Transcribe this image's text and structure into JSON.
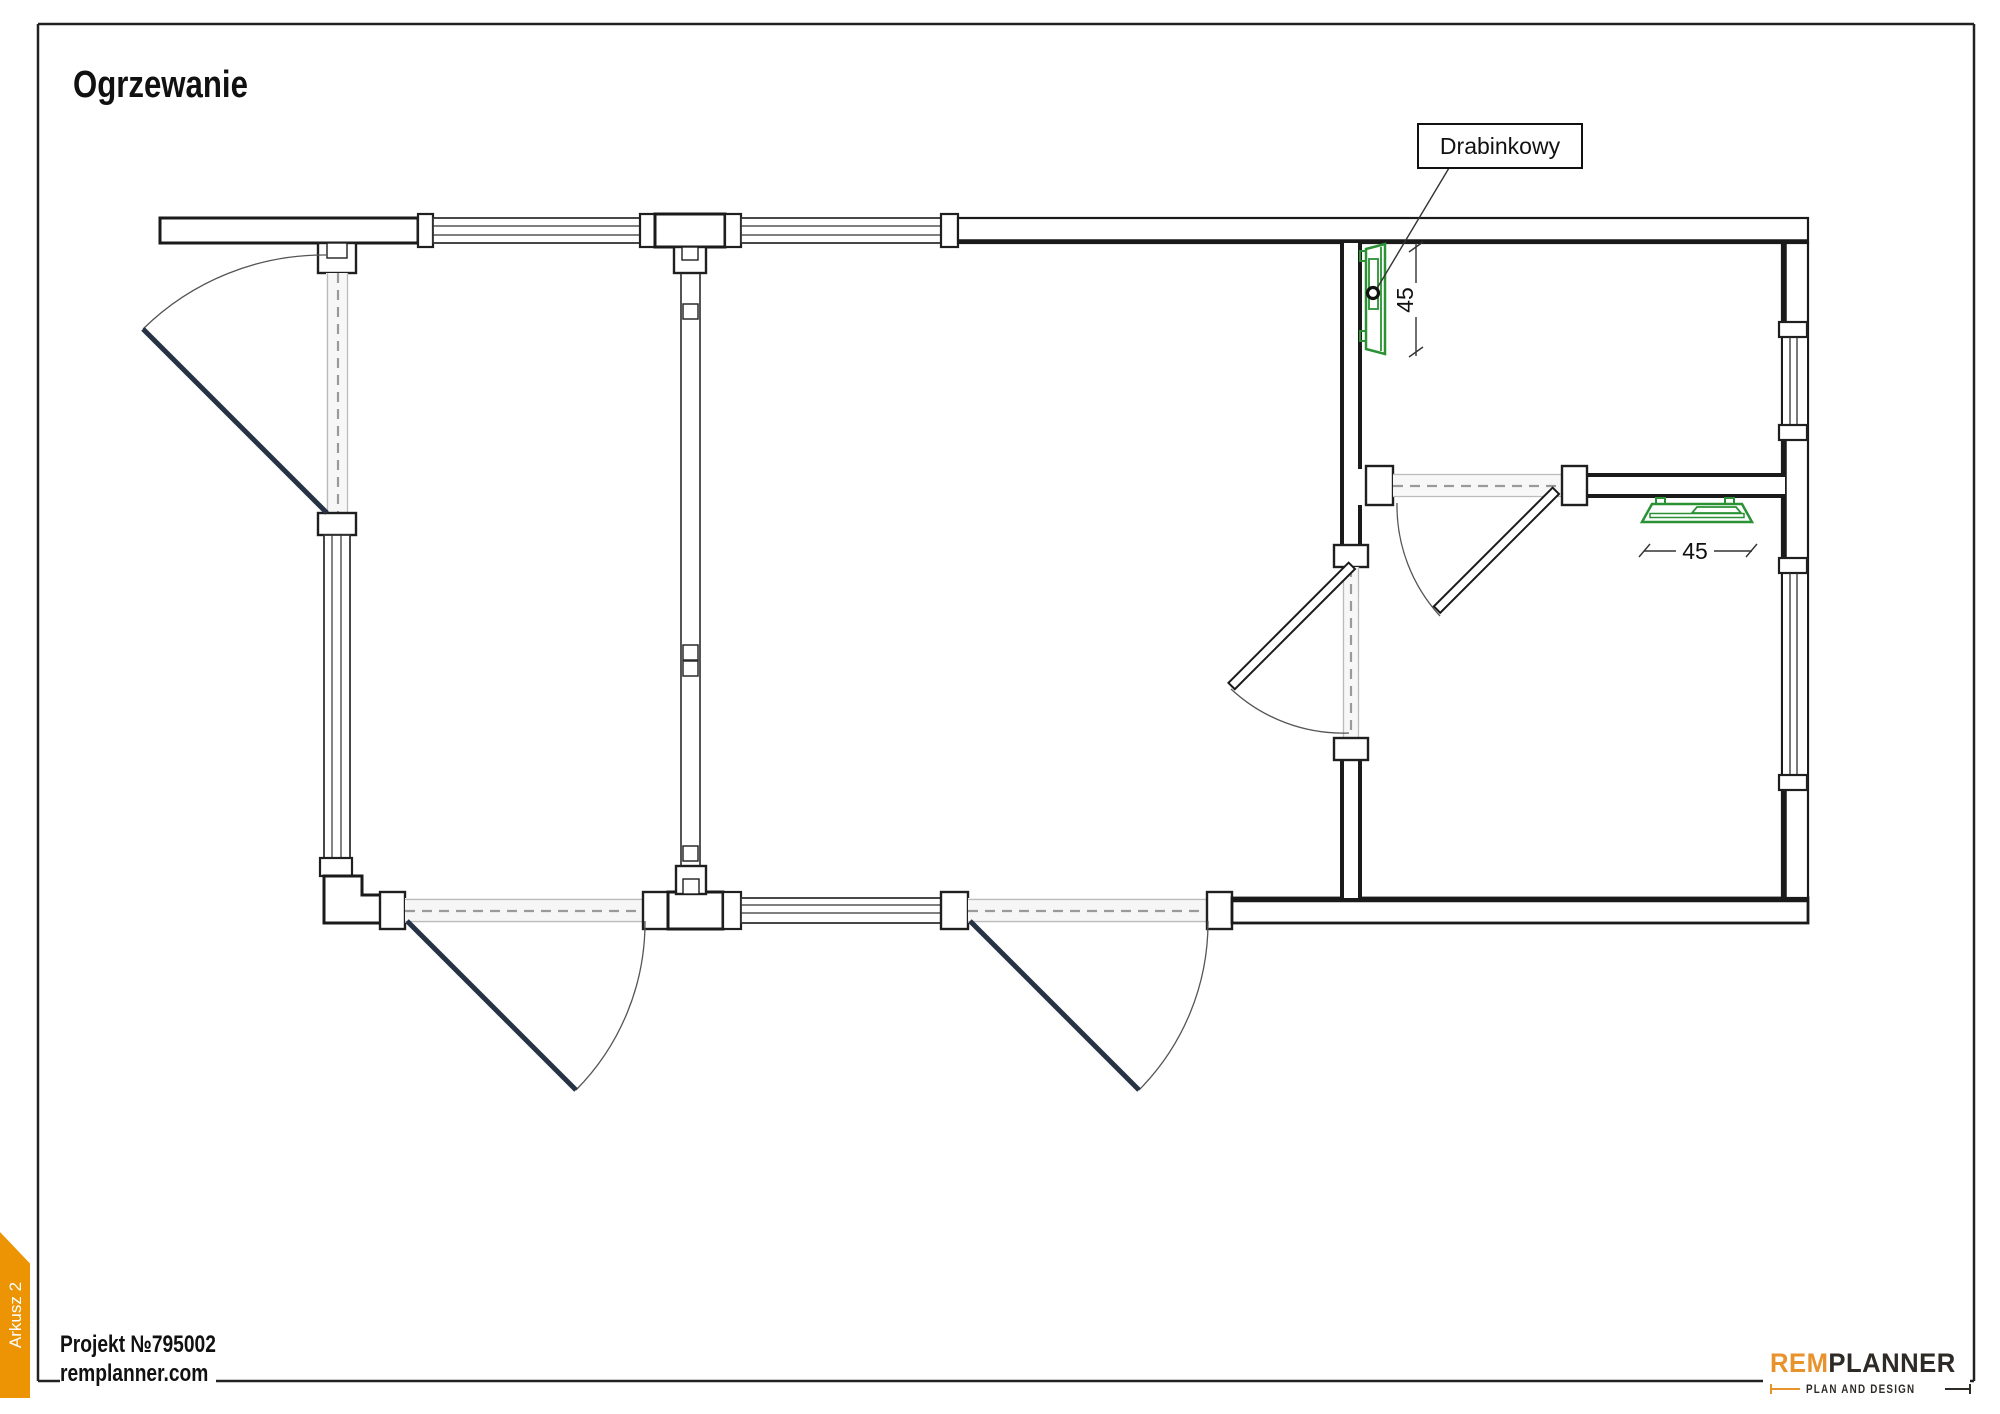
{
  "page": {
    "title": "Ogrzewanie",
    "border_color": "#222222"
  },
  "plan": {
    "annotation_label": "Drabinkowy",
    "dimensions": [
      {
        "value": "45",
        "orientation": "vertical",
        "target": "towel-radiator-top-right-room"
      },
      {
        "value": "45",
        "orientation": "horizontal",
        "target": "towel-radiator-bottom-right-room"
      }
    ],
    "radiators": [
      {
        "type": "drabinkowy-towel-radiator",
        "width_cm": "45",
        "mount": "vertical-on-partition-wall"
      },
      {
        "type": "drabinkowy-towel-radiator",
        "width_cm": "45",
        "mount": "horizontal-under-interior-wall"
      }
    ],
    "colors": {
      "radiator_green": "#2A9235",
      "door_leaf_dark": "#263345",
      "wall_black": "#1A1A1A",
      "opening_dash_gray": "#9A9A9A"
    }
  },
  "footer": {
    "project": "Projekt №795002",
    "website": "remplanner.com",
    "sheet_tab": "Arkusz 2",
    "tab_color": "#ED9405"
  },
  "logo": {
    "brand_prefix": "REM",
    "brand_suffix": "PLANNER",
    "tagline": "PLAN AND DESIGN",
    "orange": "#E8922C",
    "dark": "#2E2A26"
  }
}
